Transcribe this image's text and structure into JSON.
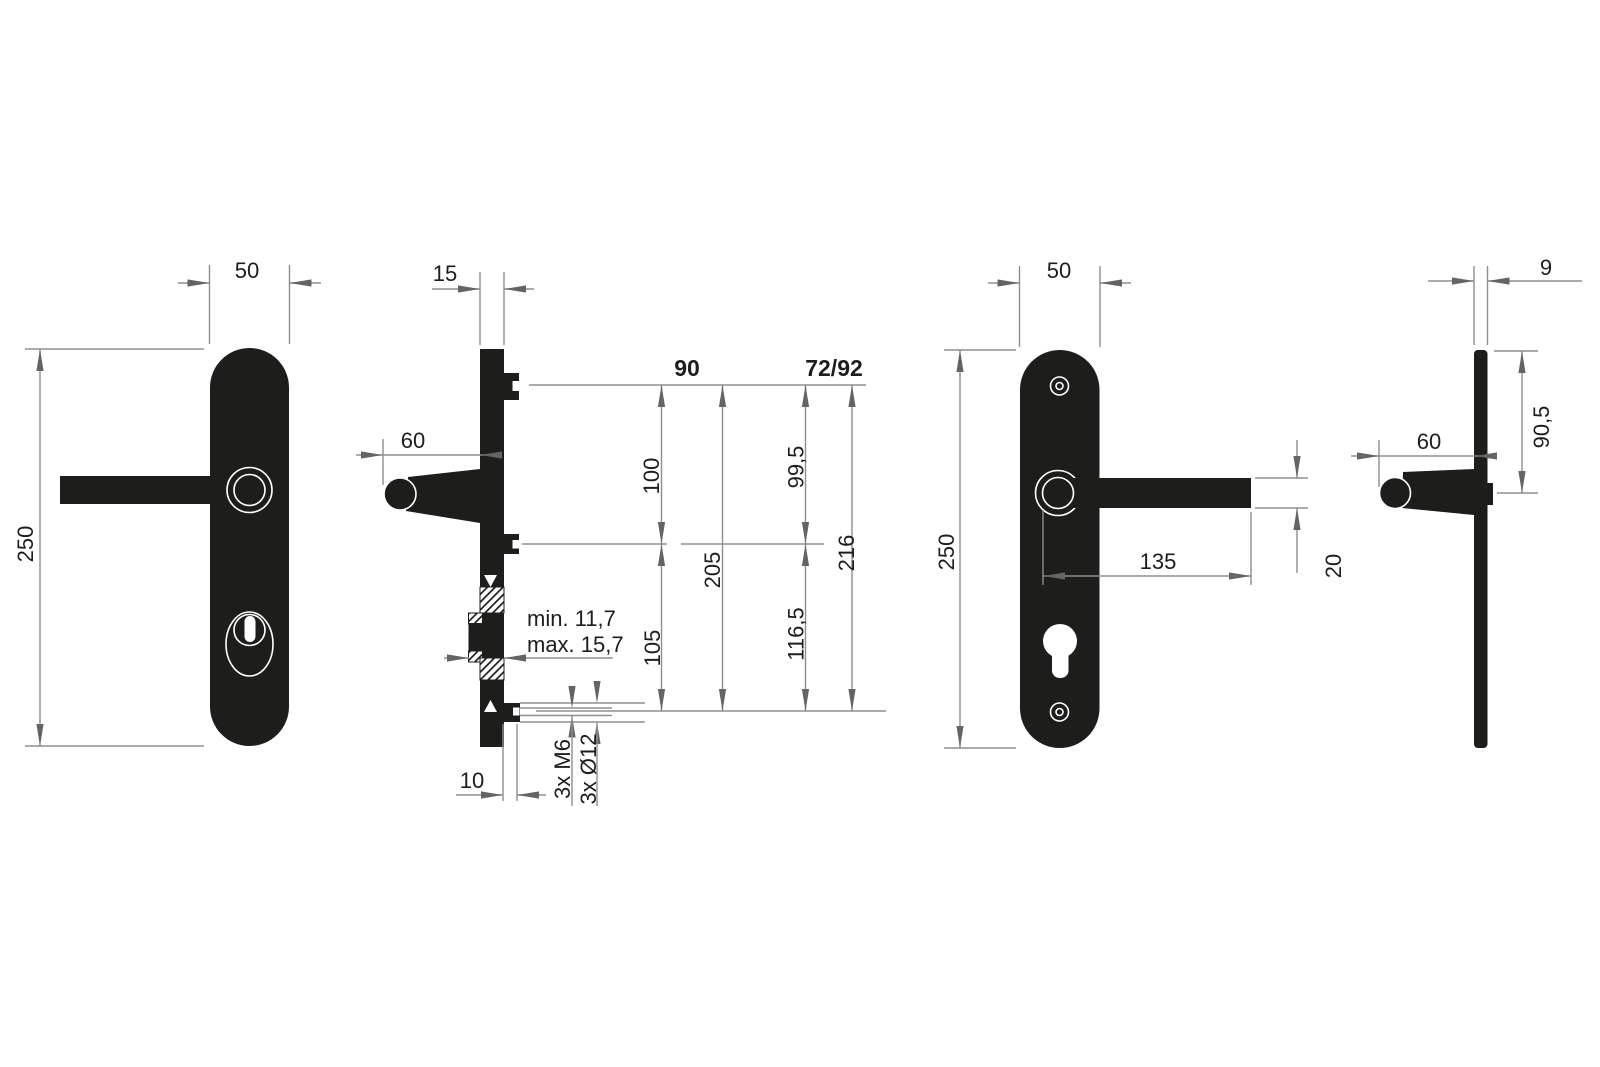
{
  "views": {
    "front_exterior": {
      "width": "50",
      "height": "250"
    },
    "side_section": {
      "thickness": "15",
      "handle_depth": "60",
      "column_a_header": "90",
      "column_b_header": "72/92",
      "a_upper": "100",
      "a_lower": "105",
      "a_total": "205",
      "b_upper": "99,5",
      "b_lower": "116,5",
      "b_total": "216",
      "cylinder_min": "min. 11,7",
      "cylinder_max": "max. 15,7",
      "lug_depth": "10",
      "thread_spec": "3x M6",
      "hole_spec": "3x Ø12"
    },
    "front_interior": {
      "width": "50",
      "height": "250",
      "handle_length": "135",
      "handle_thickness": "20"
    },
    "side_profile": {
      "thickness": "9",
      "top_to_handle": "90,5",
      "handle_depth": "60"
    }
  },
  "colors": {
    "ink": "#1d1d1b",
    "dim_line": "#8f8f8e",
    "dim_arrow": "#646463",
    "text": "#1d1d1b",
    "background": "#ffffff"
  }
}
